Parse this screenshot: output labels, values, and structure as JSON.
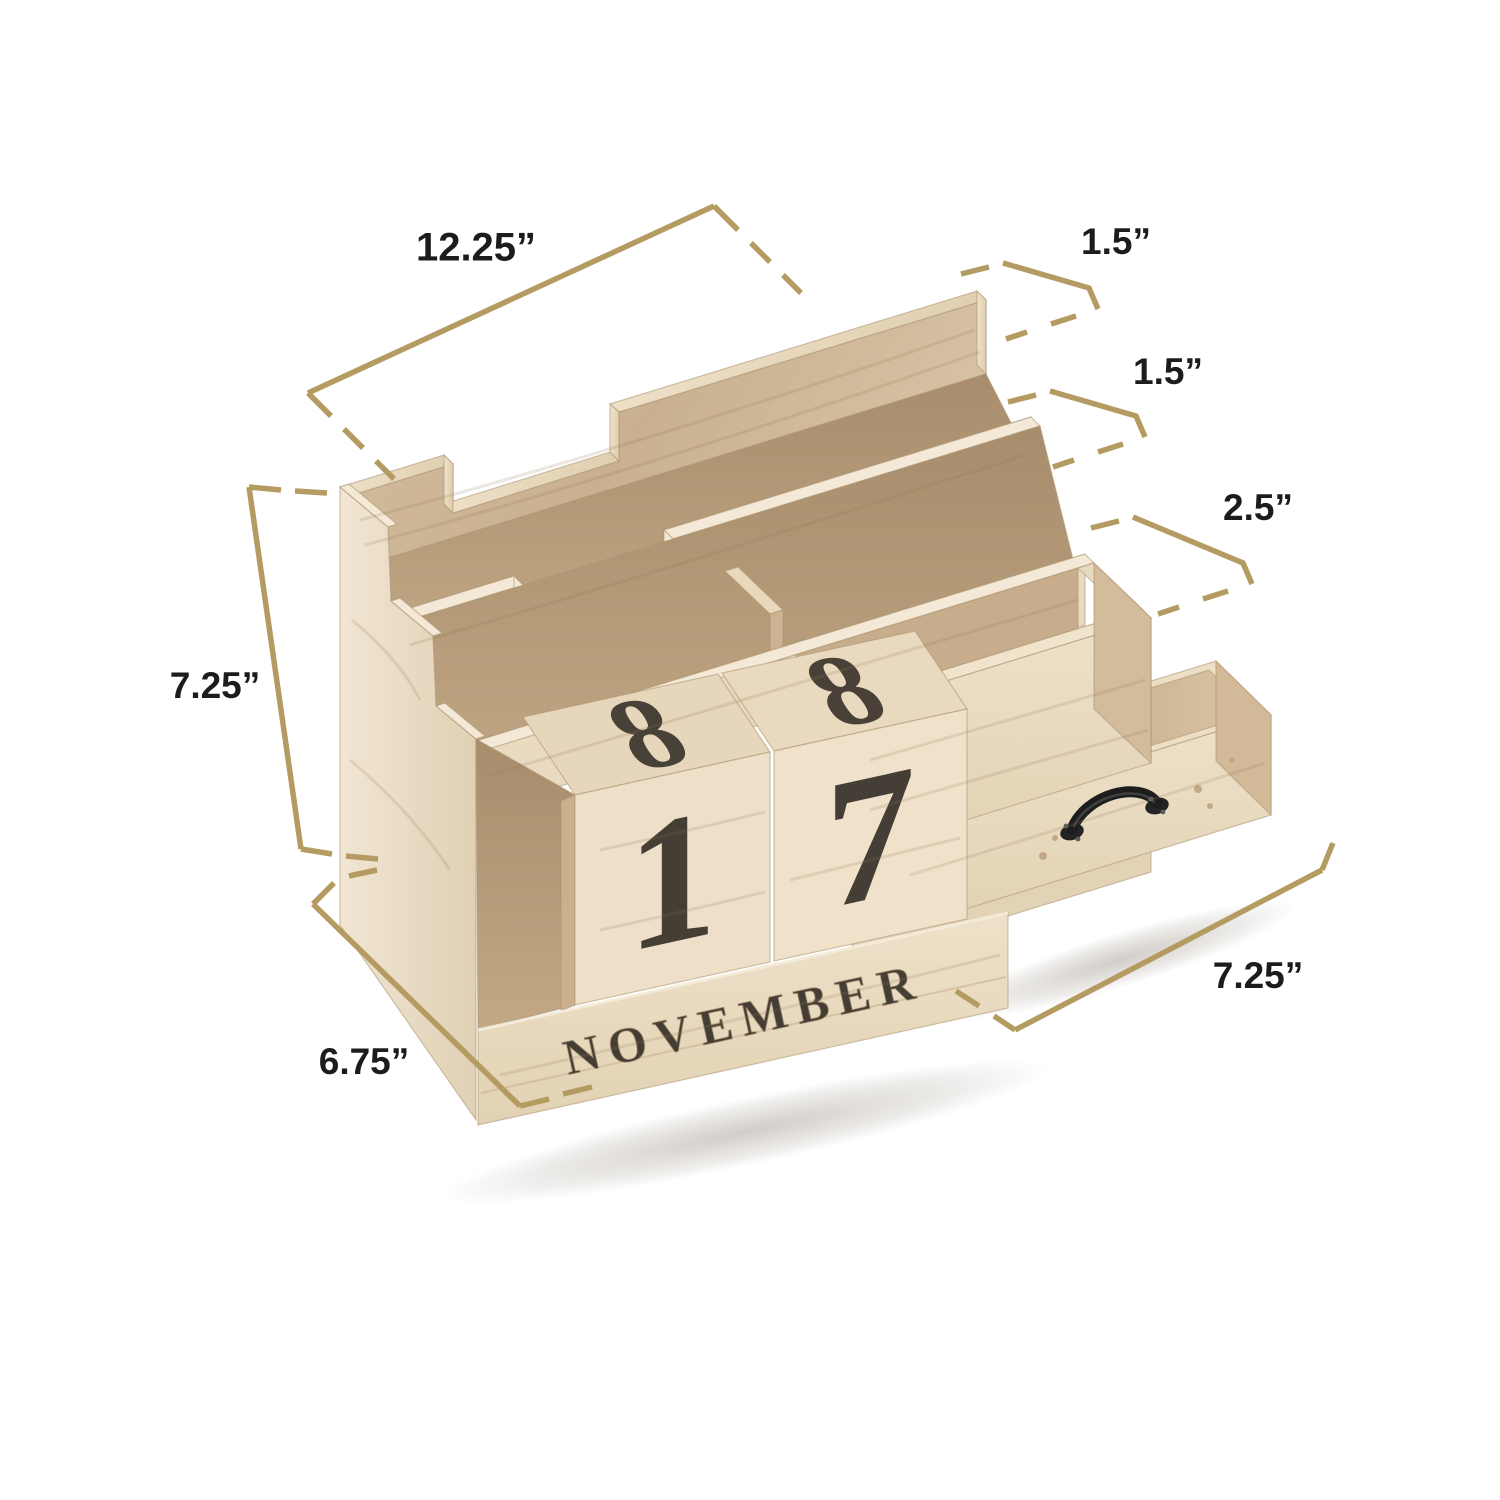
{
  "page": {
    "background": "#ffffff",
    "type": "product-dimension-diagram"
  },
  "colors": {
    "annotation_line": "#b49b61",
    "label_text": "#1c1c1c",
    "wood_light": "#efe3cd",
    "wood_mid": "#dcc9ab",
    "wood_dark": "#c3a98c",
    "wood_shadow": "#a98e6d",
    "handle_metal": "#1f1f1f"
  },
  "callouts": {
    "top_width": {
      "label": "12.25”"
    },
    "back_slot_depth": {
      "label": "1.5”"
    },
    "middle_slot_depth": {
      "label": "1.5”"
    },
    "tray_depth": {
      "label": "2.5”"
    },
    "height": {
      "label": "7.25”"
    },
    "side_depth": {
      "label": "6.75”"
    },
    "drawer_width": {
      "label": "7.25”"
    }
  },
  "calendar": {
    "top_left_digit": "8",
    "top_right_digit": "8",
    "front_left_digit": "1",
    "front_right_digit": "7",
    "month": "NOVEMBER"
  }
}
